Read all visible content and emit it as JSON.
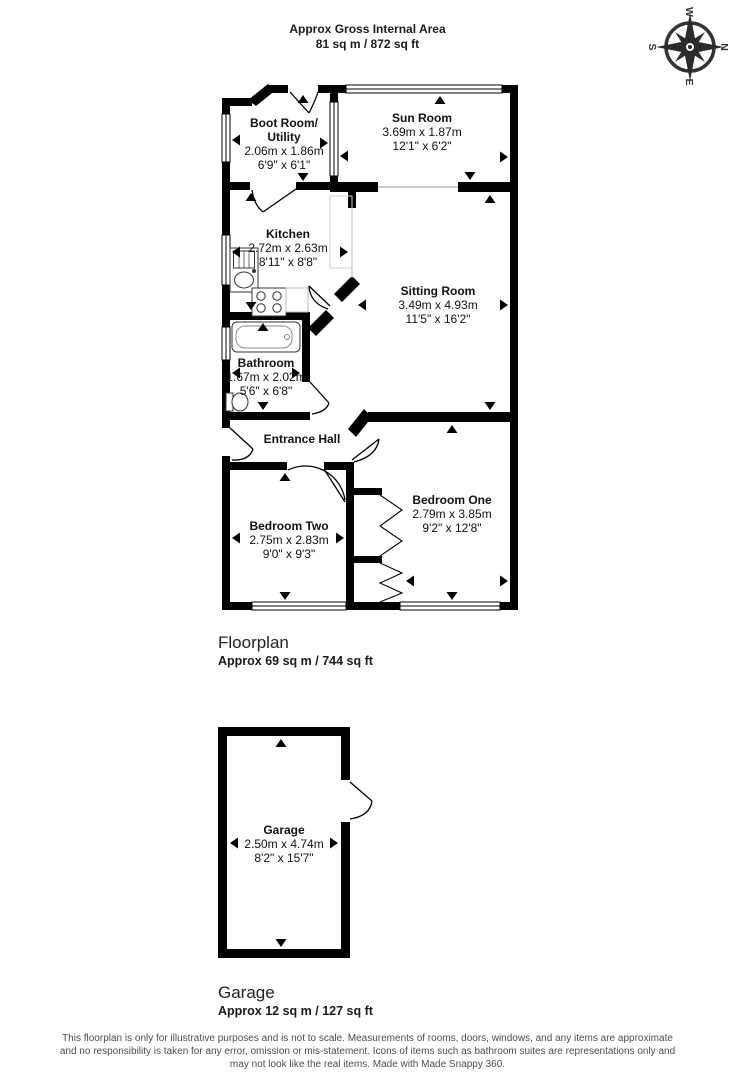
{
  "header": {
    "line1": "Approx Gross Internal Area",
    "line2": "81 sq m / 872 sq ft"
  },
  "compass": {
    "n": "N",
    "e": "E",
    "s": "S",
    "w": "W"
  },
  "rooms": {
    "boot": {
      "name1": "Boot Room/",
      "name2": "Utility",
      "metric": "2.06m x 1.86m",
      "imperial": "6'9\" x 6'1\""
    },
    "sun": {
      "name": "Sun Room",
      "metric": "3.69m x 1.87m",
      "imperial": "12'1\" x 6'2\""
    },
    "kitchen": {
      "name": "Kitchen",
      "metric": "2.72m x 2.63m",
      "imperial": "8'11\" x 8'8\""
    },
    "sitting": {
      "name": "Sitting Room",
      "metric": "3.49m x 4.93m",
      "imperial": "11'5\" x 16'2\""
    },
    "bathroom": {
      "name": "Bathroom",
      "metric": "1.67m x 2.02m",
      "imperial": "5'6\" x 6'8\""
    },
    "hall": {
      "name": "Entrance Hall"
    },
    "bedroom_two": {
      "name": "Bedroom Two",
      "metric": "2.75m x 2.83m",
      "imperial": "9'0\" x 9'3\""
    },
    "bedroom_one": {
      "name": "Bedroom One",
      "metric": "2.79m x 3.85m",
      "imperial": "9'2\" x 12'8\""
    },
    "garage": {
      "name": "Garage",
      "metric": "2.50m x 4.74m",
      "imperial": "8'2\" x 15'7\""
    }
  },
  "sections": {
    "floorplan": {
      "title": "Floorplan",
      "subtitle": "Approx 69 sq m / 744 sq ft"
    },
    "garage": {
      "title": "Garage",
      "subtitle": "Approx 12 sq m / 127 sq ft"
    }
  },
  "disclaimer": {
    "line1": "This floorplan is only for illustrative purposes and is not to scale. Measurements of rooms, doors, windows, and any items are approximate",
    "line2": "and no responsibility is taken for any error, omission or mis-statement. Icons of items such as bathroom suites are representations only and",
    "line3": "may not look like the real items. Made with Made Snappy 360."
  },
  "colors": {
    "wall": "#000000",
    "counter": "#bbbbbb",
    "disclaimer_text": "#4d4d4d"
  }
}
